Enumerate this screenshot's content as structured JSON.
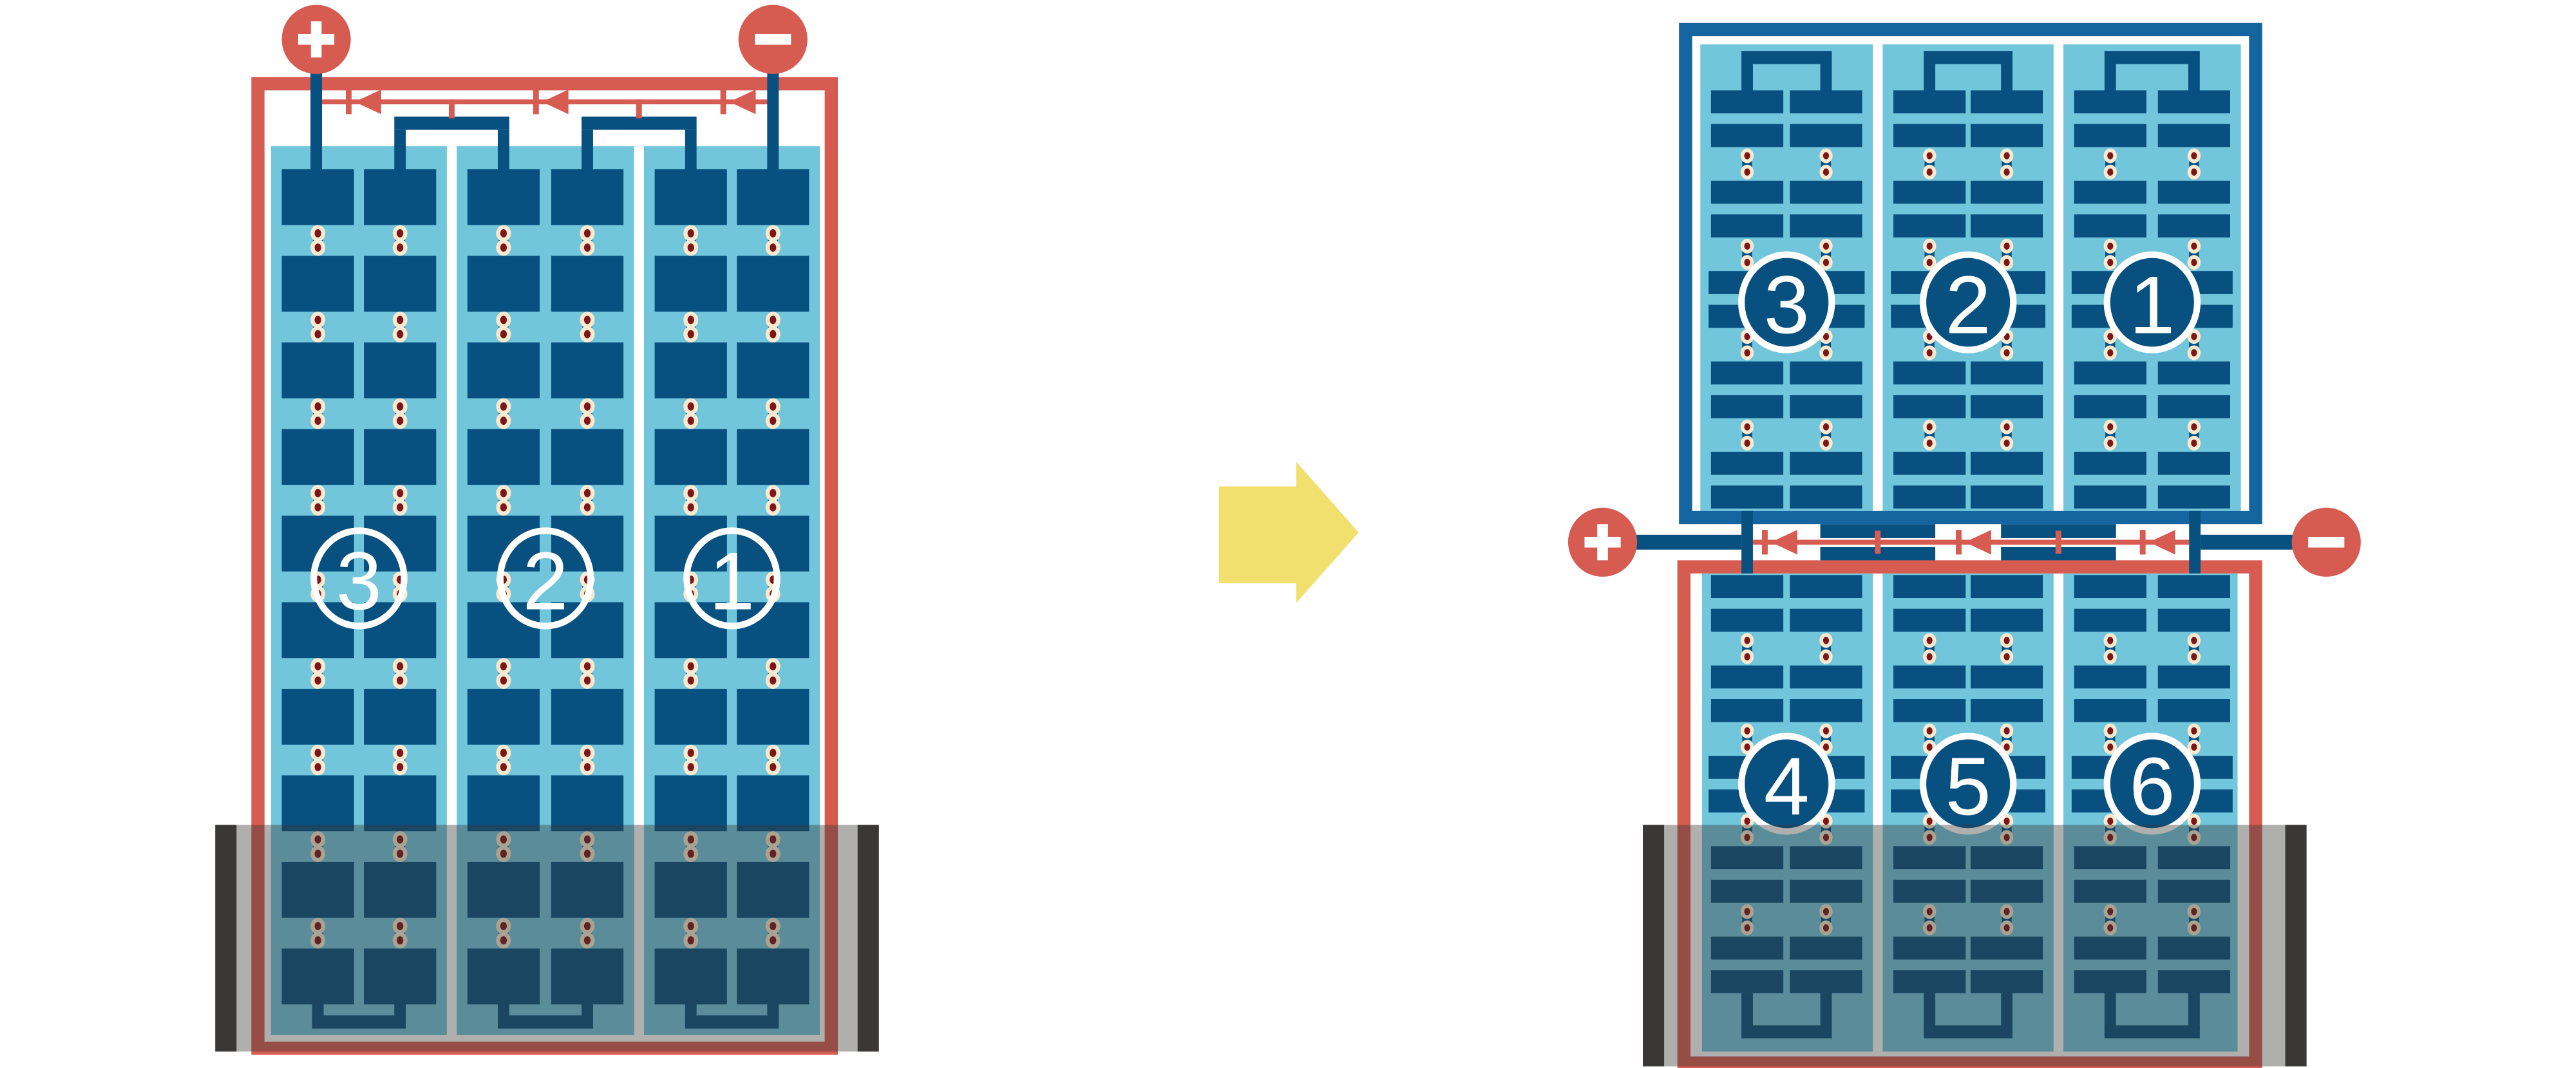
{
  "diagram": {
    "kind": "solar-module-redesign-schematic",
    "left_module": {
      "string_labels": [
        "3",
        "2",
        "1"
      ],
      "positive_terminal_label": "+",
      "negative_terminal_label": "−",
      "bypass_diode_count": 3,
      "shaded_bottom": true
    },
    "transform_arrow": "right-block-arrow",
    "right_top_module": {
      "string_labels": [
        "3",
        "2",
        "1"
      ]
    },
    "right_bottom_module": {
      "string_labels": [
        "4",
        "5",
        "6"
      ],
      "shaded_bottom": true
    },
    "junction": {
      "positive_terminal_label": "+",
      "negative_terminal_label": "−",
      "bypass_diode_count": 3
    },
    "colors": {
      "background": "#ffffff",
      "accent_red": "#d65c52",
      "navy": "#07507f",
      "frame_blue": "#1565a0",
      "panel_light_blue": "#72c6dc",
      "solder_dot_cream": "#f7ead0",
      "solder_dot_maroon": "#7e1517",
      "arrow_yellow": "#f2e06e",
      "shade_overlay": "rgba(56,54,52,0.4)",
      "shade_cap": "#3a3837",
      "label_white": "#ffffff"
    }
  }
}
